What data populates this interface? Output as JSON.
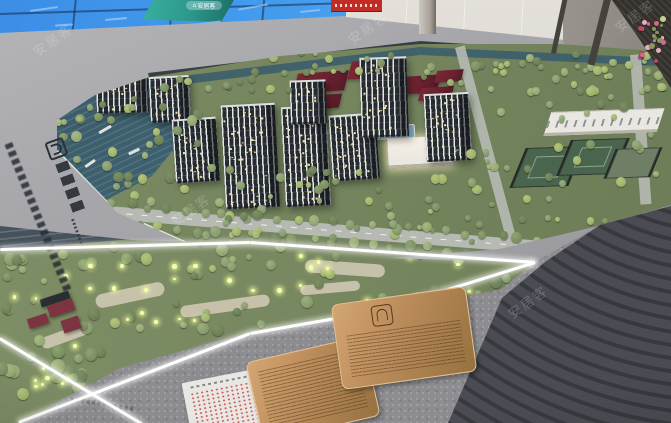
{
  "watermark": {
    "text": "安居客",
    "badge_text": "安居客",
    "badge_icon": "⌂"
  },
  "palette": {
    "screen_blue": "#459ced",
    "screen_teal": "#2b978a",
    "wall_white": "#ddd8d1",
    "wall_right": "#a9a49e",
    "led_red": "#c22c26",
    "base_gray": "#a7a7ab",
    "base_gray_dark": "#8e8e93",
    "model_green": "#75855e",
    "water_teal": "#3e5f6c",
    "road_gray": "#b6bab3",
    "path_white": "#f2f3ef",
    "tower_dark": "#262b30",
    "tower_light": "#e2e5e5",
    "window_warm": "#ffe9a8",
    "roof_red": "#6b2130",
    "court_green": "#4a654d",
    "school_white": "#e9e7e1",
    "park_green": "#77875f",
    "park_path": "#cfc8b2",
    "glow_yellow": "#f4ffad",
    "pavilion_red": "#7b3440",
    "granite": "#8d8d91",
    "terrace_dark": "#38383f",
    "terrace_light": "#4b4b53",
    "plaque_bronze": "#c0905f",
    "plaque_bronze_dark": "#96713f",
    "paper_white": "#e8e7e3",
    "paper_red": "#c8413a",
    "strip_white": "#ffffff"
  }
}
